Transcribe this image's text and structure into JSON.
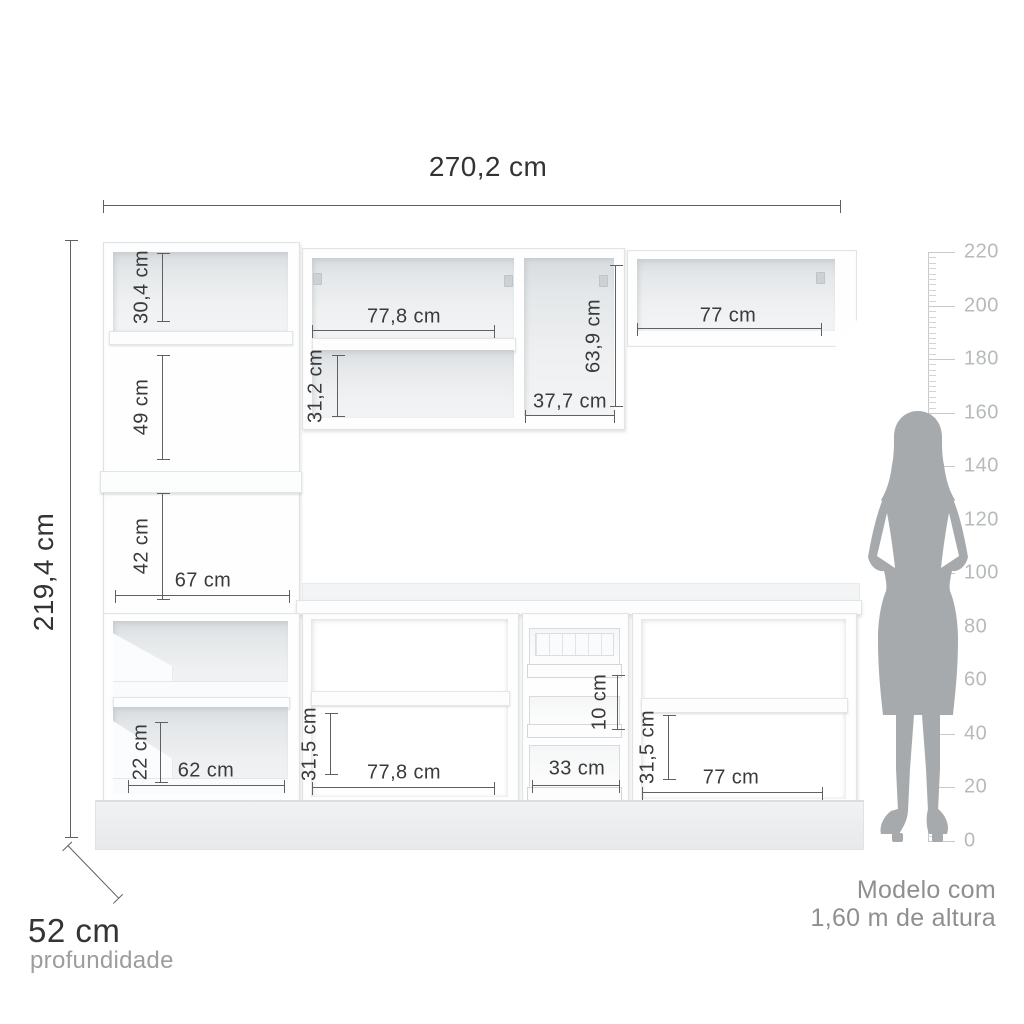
{
  "overall": {
    "total_width": "270,2 cm",
    "total_height": "219,4 cm",
    "depth": "52 cm",
    "depth_caption": "profundidade"
  },
  "dims": {
    "tower_top": "30,4 cm",
    "tower_mid": "49 cm",
    "tower_low": "42 cm",
    "tower_width": "67 cm",
    "wall_center_width": "77,8 cm",
    "wall_center_shelf": "31,2 cm",
    "wall_tall_height": "63,9 cm",
    "wall_tall_width": "37,7 cm",
    "wall_right_width": "77 cm",
    "base_left_drawer": "22 cm",
    "base_left_width": "62 cm",
    "base_center_shelf": "31,5 cm",
    "base_center_width": "77,8 cm",
    "drawer_gap": "10 cm",
    "drawer_width": "33 cm",
    "base_right_shelf": "31,5 cm",
    "base_right_width": "77 cm"
  },
  "ruler": {
    "labels": [
      "220",
      "200",
      "180",
      "160",
      "140",
      "120",
      "100",
      "80",
      "60",
      "40",
      "20",
      "0"
    ]
  },
  "model_note": {
    "line1": "Modelo com",
    "line2": "1,60 m de altura"
  },
  "colors": {
    "dimension_line": "#5f6062",
    "label_text": "#3a3a3c",
    "muted_text": "#8d8f91",
    "ruler_gray": "#c6c9cb",
    "silhouette_gray": "#a7aaac",
    "cabinet_interior": "#e4e7e9",
    "background": "#ffffff"
  }
}
